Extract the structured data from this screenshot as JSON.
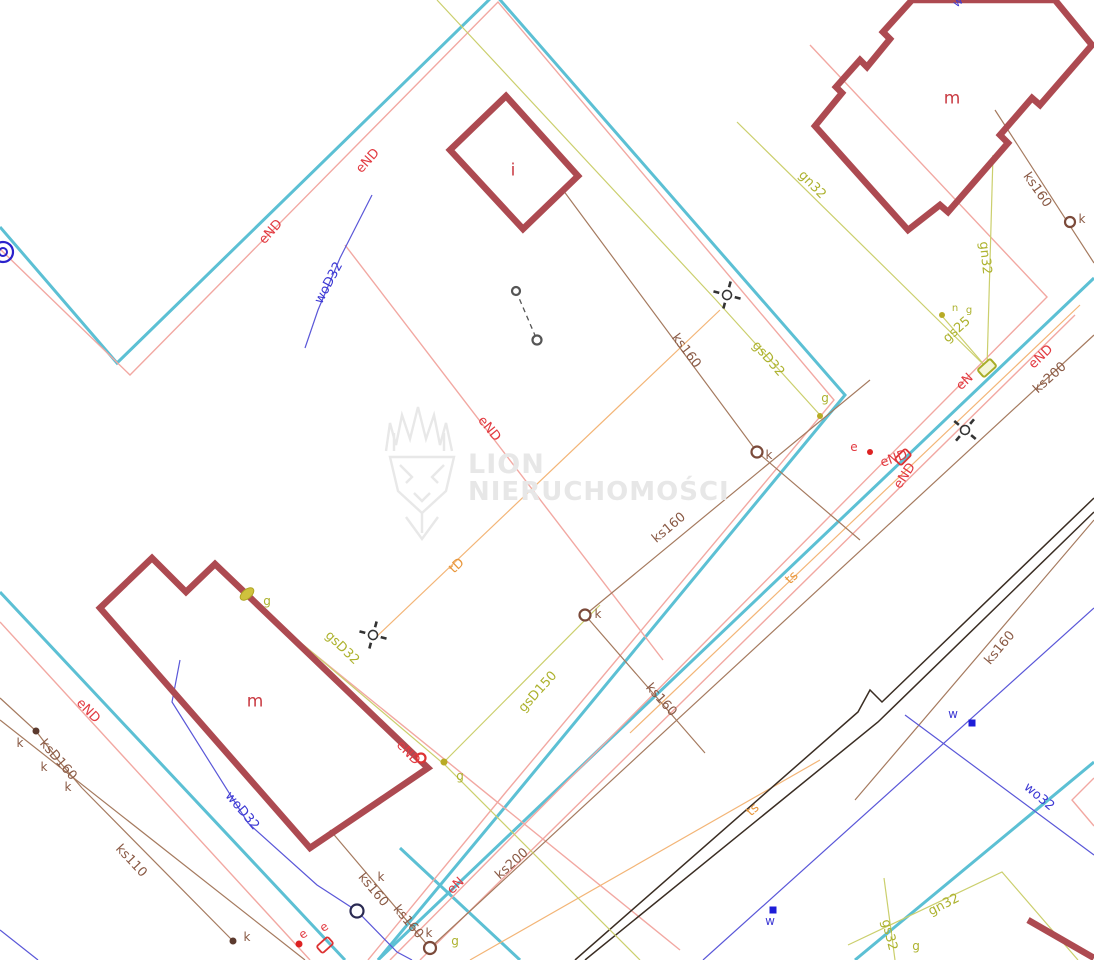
{
  "map": {
    "title": "cadastral-utility-map",
    "watermark": {
      "line1": "LION",
      "line2": "NIERUCHOMOŚCI"
    },
    "palette": {
      "parcel_cyan": "#5cc0d4",
      "power_salmon": "#f2a8a2",
      "power_label_red": "#e23a41",
      "telecom_orange": "#e8973c",
      "telecom_line": "#f3b577",
      "sewer_brown_label": "#8a5a45",
      "sewer_brown_line": "#a57a5f",
      "sewer_dot_dark": "#5b3a2e",
      "gas_olive_label": "#adb22e",
      "gas_olive_line": "#cbcf6d",
      "gas_dot": "#b8ab25",
      "water_blue_label": "#3d39d4",
      "water_blue_line": "#5a57d8",
      "water_dot": "#1d1dd8",
      "road_dark": "#3a2d23",
      "building_stroke": "#ad4a51",
      "building_label": "#c93a42",
      "manhole_ring_brown": "#7b4a3a",
      "manhole_ring_navy": "#2a2a52",
      "survey_black": "#333333",
      "well_blue": "#2a22cc",
      "marker_red": "#dd3333"
    },
    "buildings": [
      {
        "label": "i",
        "x": 513,
        "y": 171
      },
      {
        "label": "m",
        "x": 952,
        "y": 99
      },
      {
        "label": "m",
        "x": 255,
        "y": 702
      }
    ],
    "labels": [
      {
        "t": "eND",
        "x": 368,
        "y": 161,
        "r": -48,
        "cls": "red"
      },
      {
        "t": "eND",
        "x": 271,
        "y": 232,
        "r": -48,
        "cls": "red"
      },
      {
        "t": "eND",
        "x": 489,
        "y": 429,
        "r": 51,
        "cls": "red"
      },
      {
        "t": "eND",
        "x": 88,
        "y": 711,
        "r": 46,
        "cls": "red"
      },
      {
        "t": "eND",
        "x": 408,
        "y": 753,
        "r": 46,
        "cls": "red"
      },
      {
        "t": "eN",
        "x": 456,
        "y": 886,
        "r": -44,
        "cls": "red"
      },
      {
        "t": "eN",
        "x": 965,
        "y": 382,
        "r": -44,
        "cls": "red"
      },
      {
        "t": "eND",
        "x": 1041,
        "y": 357,
        "r": -44,
        "cls": "red"
      },
      {
        "t": "e",
        "x": 854,
        "y": 447,
        "r": 0,
        "cls": "red",
        "fs": 12
      },
      {
        "t": "eND",
        "x": 894,
        "y": 459,
        "r": -20,
        "cls": "red"
      },
      {
        "t": "eND",
        "x": 905,
        "y": 476,
        "r": -56,
        "cls": "red"
      },
      {
        "t": "e",
        "x": 303,
        "y": 934,
        "r": -35,
        "cls": "red",
        "fs": 12
      },
      {
        "t": "e",
        "x": 324,
        "y": 927,
        "r": -35,
        "cls": "red",
        "fs": 12
      },
      {
        "t": "tD",
        "x": 457,
        "y": 566,
        "r": -44,
        "cls": "orange"
      },
      {
        "t": "ts",
        "x": 792,
        "y": 578,
        "r": -44,
        "cls": "orange"
      },
      {
        "t": "ts",
        "x": 753,
        "y": 810,
        "r": -44,
        "cls": "orange"
      },
      {
        "t": "ks160",
        "x": 686,
        "y": 351,
        "r": 53,
        "cls": "brown"
      },
      {
        "t": "ks160",
        "x": 669,
        "y": 528,
        "r": -40,
        "cls": "brown"
      },
      {
        "t": "ks160",
        "x": 661,
        "y": 700,
        "r": 48,
        "cls": "brown"
      },
      {
        "t": "ks160",
        "x": 1000,
        "y": 648,
        "r": -50,
        "cls": "brown"
      },
      {
        "t": "ks160",
        "x": 1037,
        "y": 190,
        "r": 55,
        "cls": "brown"
      },
      {
        "t": "ks200",
        "x": 512,
        "y": 864,
        "r": -42,
        "cls": "brown"
      },
      {
        "t": "ks200",
        "x": 1050,
        "y": 378,
        "r": -42,
        "cls": "brown"
      },
      {
        "t": "ksD160",
        "x": 58,
        "y": 760,
        "r": 49,
        "cls": "brown"
      },
      {
        "t": "ks110",
        "x": 131,
        "y": 861,
        "r": 47,
        "cls": "brown"
      },
      {
        "t": "ks160",
        "x": 373,
        "y": 890,
        "r": 50,
        "cls": "brown"
      },
      {
        "t": "ks160",
        "x": 408,
        "y": 922,
        "r": 50,
        "cls": "brown"
      },
      {
        "t": "k",
        "x": 769,
        "y": 455,
        "r": 0,
        "cls": "brown",
        "fs": 12
      },
      {
        "t": "k",
        "x": 598,
        "y": 614,
        "r": 0,
        "cls": "brown",
        "fs": 12
      },
      {
        "t": "k",
        "x": 1082,
        "y": 219,
        "r": 0,
        "cls": "brown",
        "fs": 12
      },
      {
        "t": "k",
        "x": 20,
        "y": 743,
        "r": 0,
        "cls": "brown",
        "fs": 12
      },
      {
        "t": "k",
        "x": 44,
        "y": 767,
        "r": 0,
        "cls": "brown",
        "fs": 12
      },
      {
        "t": "k",
        "x": 68,
        "y": 787,
        "r": 0,
        "cls": "brown",
        "fs": 12
      },
      {
        "t": "k",
        "x": 247,
        "y": 937,
        "r": 0,
        "cls": "brown",
        "fs": 12
      },
      {
        "t": "k",
        "x": 381,
        "y": 877,
        "r": 0,
        "cls": "brown",
        "fs": 12
      },
      {
        "t": "k",
        "x": 429,
        "y": 933,
        "r": 0,
        "cls": "brown",
        "fs": 12
      },
      {
        "t": "woD32",
        "x": 329,
        "y": 283,
        "r": -62,
        "cls": "blue"
      },
      {
        "t": "woD32",
        "x": 242,
        "y": 811,
        "r": 50,
        "cls": "blue"
      },
      {
        "t": "wo32",
        "x": 1039,
        "y": 797,
        "r": 40,
        "cls": "blue"
      },
      {
        "t": "w",
        "x": 953,
        "y": 714,
        "r": 0,
        "cls": "blue",
        "fs": 12
      },
      {
        "t": "w",
        "x": 770,
        "y": 921,
        "r": 0,
        "cls": "blue",
        "fs": 12
      },
      {
        "t": "w",
        "x": 958,
        "y": 2,
        "r": -40,
        "cls": "blue",
        "fs": 11
      },
      {
        "t": "gsD32",
        "x": 768,
        "y": 359,
        "r": 49,
        "cls": "olive"
      },
      {
        "t": "gsD32",
        "x": 342,
        "y": 648,
        "r": 44,
        "cls": "olive"
      },
      {
        "t": "gsD150",
        "x": 538,
        "y": 692,
        "r": -48,
        "cls": "olive"
      },
      {
        "t": "gn32",
        "x": 812,
        "y": 185,
        "r": 46,
        "cls": "olive"
      },
      {
        "t": "gn32",
        "x": 985,
        "y": 258,
        "r": 84,
        "cls": "olive"
      },
      {
        "t": "gn32",
        "x": 944,
        "y": 905,
        "r": -27,
        "cls": "olive"
      },
      {
        "t": "gs25",
        "x": 957,
        "y": 330,
        "r": -42,
        "cls": "olive"
      },
      {
        "t": "gs32",
        "x": 889,
        "y": 935,
        "r": 76,
        "cls": "olive"
      },
      {
        "t": "g",
        "x": 825,
        "y": 398,
        "r": 0,
        "cls": "olive",
        "fs": 12
      },
      {
        "t": "g",
        "x": 267,
        "y": 601,
        "r": 0,
        "cls": "olive",
        "fs": 12
      },
      {
        "t": "g",
        "x": 460,
        "y": 776,
        "r": 0,
        "cls": "olive",
        "fs": 12
      },
      {
        "t": "g",
        "x": 916,
        "y": 946,
        "r": 0,
        "cls": "olive",
        "fs": 12
      },
      {
        "t": "g",
        "x": 455,
        "y": 941,
        "r": 0,
        "cls": "olive",
        "fs": 12
      },
      {
        "t": "n",
        "x": 955,
        "y": 309,
        "r": 0,
        "cls": "olive",
        "fs": 10
      },
      {
        "t": "g",
        "x": 969,
        "y": 311,
        "r": 0,
        "cls": "olive",
        "fs": 10
      }
    ],
    "markers": [
      {
        "type": "manhole",
        "x": 757,
        "y": 452,
        "r": 5.5,
        "c": "#7b4a3a"
      },
      {
        "type": "manhole",
        "x": 585,
        "y": 615,
        "r": 5.5,
        "c": "#7b4a3a"
      },
      {
        "type": "manhole",
        "x": 1070,
        "y": 222,
        "r": 5,
        "c": "#7b4a3a"
      },
      {
        "type": "manhole",
        "x": 430,
        "y": 948,
        "r": 6,
        "c": "#7b4a3a"
      },
      {
        "type": "manhole",
        "x": 357,
        "y": 911,
        "r": 6.5,
        "c": "#2a2a52"
      },
      {
        "type": "manhole",
        "x": 516,
        "y": 291,
        "r": 4,
        "c": "#555555"
      },
      {
        "type": "manhole",
        "x": 537,
        "y": 340,
        "r": 4.5,
        "c": "#555555"
      },
      {
        "type": "manhole",
        "x": 421,
        "y": 758,
        "r": 4.5,
        "c": "#dd3333"
      },
      {
        "type": "well",
        "x": 3,
        "y": 252
      },
      {
        "type": "dot",
        "x": 36,
        "y": 731,
        "r": 3.5,
        "c": "#5b3a2e"
      },
      {
        "type": "dot",
        "x": 233,
        "y": 941,
        "r": 3.5,
        "c": "#5b3a2e"
      },
      {
        "type": "dot",
        "x": 299,
        "y": 944,
        "r": 3.5,
        "c": "#dd2222"
      },
      {
        "type": "dot",
        "x": 870,
        "y": 452,
        "r": 3,
        "c": "#dd2222"
      },
      {
        "type": "dot",
        "x": 820,
        "y": 416,
        "r": 3,
        "c": "#b8ab25"
      },
      {
        "type": "dot",
        "x": 444,
        "y": 762,
        "r": 3.5,
        "c": "#b8ab25"
      },
      {
        "type": "dot",
        "x": 942,
        "y": 315,
        "r": 3,
        "c": "#b8ab25"
      },
      {
        "type": "square",
        "x": 972,
        "y": 723,
        "s": 7,
        "c": "#1d1dd8"
      },
      {
        "type": "square",
        "x": 773,
        "y": 910,
        "s": 7,
        "c": "#1d1dd8"
      },
      {
        "type": "ellipse",
        "x": 247,
        "y": 594,
        "rot": -40
      },
      {
        "type": "gasbox",
        "x": 987,
        "y": 368,
        "rot": -42
      },
      {
        "type": "ebox",
        "x": 325,
        "y": 945,
        "rot": -42
      },
      {
        "type": "ebox",
        "x": 903,
        "y": 457,
        "rot": -45
      },
      {
        "type": "survey",
        "x": 727,
        "y": 295,
        "rot": 15
      },
      {
        "type": "survey",
        "x": 373,
        "y": 635,
        "rot": 15
      },
      {
        "type": "survey",
        "x": 965,
        "y": 430,
        "rot": 40
      }
    ]
  }
}
